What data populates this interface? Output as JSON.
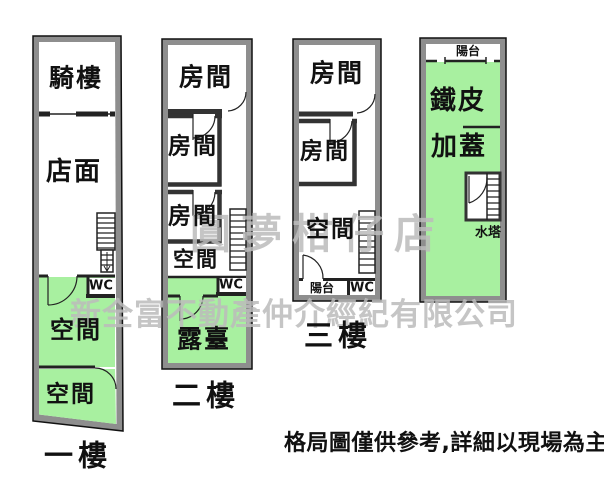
{
  "plans": {
    "floor1": {
      "name": "一樓",
      "arcade": "騎樓",
      "storefront": "店面",
      "space_upper": "空間",
      "space_lower": "空間",
      "wc": "WC"
    },
    "floor2": {
      "name": "二樓",
      "room_top": "房間",
      "room_mid": "房間",
      "room_low": "房間",
      "space": "空間",
      "terrace": "露臺",
      "wc": "WC"
    },
    "floor3": {
      "name": "三樓",
      "room_top": "房間",
      "room_mid": "房間",
      "space": "空間",
      "balcony": "陽台",
      "wc": "WC"
    },
    "rooftop": {
      "name_line1": "鐵皮",
      "name_line2": "加蓋",
      "balcony": "陽台",
      "water_tank": "水塔"
    }
  },
  "watermarks": {
    "brand_slogan": "圓夢柑仔店",
    "company_name": "新全富不動產仲介經紀有限公司"
  },
  "footer": {
    "disclaimer": "格局圖僅供參考,詳細以現場為主"
  },
  "colors": {
    "room_green": "#a8f0a0",
    "wall_gray": "#8e8e8e",
    "watermark_gray": "#bcbcbc",
    "text_black": "#111111"
  }
}
